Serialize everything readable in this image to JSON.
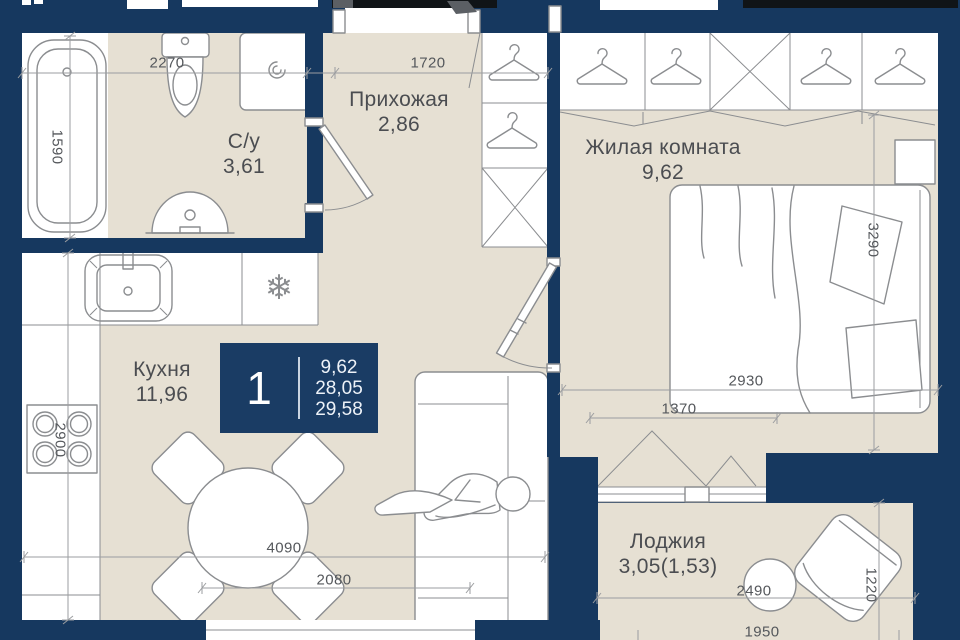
{
  "plan": {
    "type": "apartment-floor-plan",
    "rooms": {
      "bathroom": {
        "name": "С/у",
        "area": "3,61"
      },
      "hallway": {
        "name": "Прихожая",
        "area": "2,86"
      },
      "living": {
        "name": "Жилая комната",
        "area": "9,62"
      },
      "kitchen": {
        "name": "Кухня",
        "area": "11,96"
      },
      "loggia": {
        "name": "Лоджия",
        "area": "3,05(1,53)"
      }
    },
    "badge": {
      "rooms_count": "1",
      "living_area": "9,62",
      "area_without_loggia": "28,05",
      "total_area": "29,58"
    },
    "dimensions": {
      "bath_width": "2270",
      "hall_width": "1720",
      "bath_depth": "1590",
      "kitchen_depth": "2900",
      "bed_wall": "3290",
      "living_width": "2930",
      "window_width": "1370",
      "kitchen_width": "4090",
      "kitchen_window_width": "2080",
      "loggia_width": "2490",
      "loggia_glazing_width": "1950",
      "loggia_depth": "1220"
    },
    "icons": {
      "snowflake": "❄"
    },
    "colors": {
      "wall": "#16385f",
      "floor": "#e6e0d3",
      "fixture_stroke": "#8b8d90",
      "dim_line": "#9b9da0",
      "dim_text": "#55585c",
      "label_text": "#4b4d51",
      "badge_bg": "#1a3c64",
      "badge_text": "#edf2f8"
    }
  }
}
